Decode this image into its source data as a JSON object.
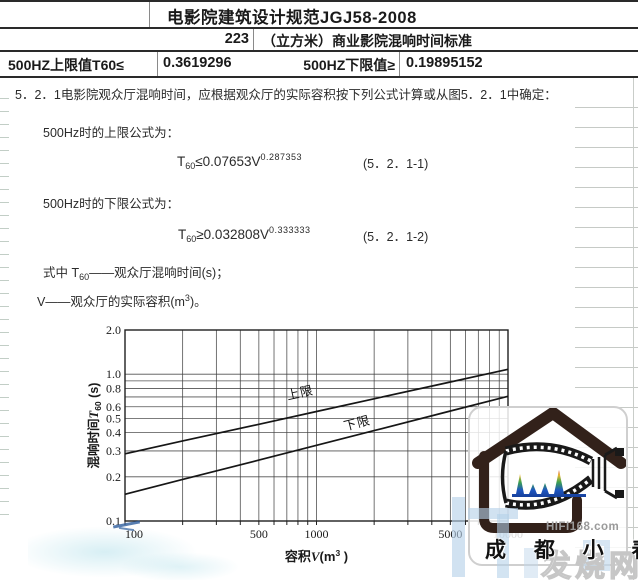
{
  "colors": {
    "table_border": "#2a2a2a",
    "grid_line": "#3f3f3f",
    "series_line": "#161616",
    "watermark_brown": "#32211a",
    "watermark_blue": "#b4d0e8",
    "hifi_gray": "#9a9a9a",
    "fsw_gray": "#c6c6c6"
  },
  "sheet": {
    "title": "电影院建筑设计规范JGJ58-2008",
    "volume_value": "223",
    "volume_caption": "（立方米）商业影院混响时间标准",
    "upper_label": "500HZ上限值T60≤",
    "upper_value": "0.3619296",
    "lower_label": "500HZ下限值≥",
    "lower_value": "0.19895152"
  },
  "body": {
    "clause": "5．2．1电影院观众厅混响时间，应根据观众厅的实际容积按下列公式计算或从图5．2．1中确定：",
    "upper_intro": "500Hz时的上限公式为：",
    "formula_upper": {
      "t": "T",
      "sub": "60",
      "mid": "≤0.07653V",
      "sup": "0.287353",
      "eq_no": "(5．2．1-1)"
    },
    "lower_intro": "500Hz时的下限公式为：",
    "formula_lower": {
      "t": "T",
      "sub": "60",
      "mid": "≥0.032808V",
      "sup": "0.333333",
      "eq_no": "(5．2．1-2)"
    },
    "where_t": {
      "pre": "式中 T",
      "sub": "60",
      "post": "——观众厅混响时间(s)；"
    },
    "where_v": {
      "pre": "V——观众厅的实际容积(m",
      "sup": "3",
      "post": ")。"
    }
  },
  "chart_data": {
    "type": "line",
    "x_scale": "log",
    "y_scale": "log",
    "xlabel": "容积V(m³)",
    "ylabel": "混响时间T60(s)",
    "xlabel_parts": [
      {
        "t": "容积"
      },
      {
        "t": "V",
        "i": true
      },
      {
        "t": "(m"
      },
      {
        "t": "3",
        "sup": true
      },
      {
        "t": ")"
      }
    ],
    "ylabel_parts": [
      {
        "t": "混响时间"
      },
      {
        "t": "T",
        "i": true
      },
      {
        "t": "60",
        "sub": true
      },
      {
        "t": "(s)"
      }
    ],
    "xlim": [
      100,
      10000
    ],
    "ylim": [
      0.1,
      2.0
    ],
    "x_ticks": [
      100,
      500,
      1000,
      5000,
      10000
    ],
    "x_tick_labels": [
      "100",
      "500",
      "1000",
      "5000",
      "10000"
    ],
    "y_ticks": [
      0.1,
      0.2,
      0.3,
      0.4,
      0.5,
      0.6,
      0.8,
      1.0,
      2.0
    ],
    "y_tick_labels": [
      "0.1",
      "0.2",
      "0.3",
      "0.4",
      "0.5",
      "0.6",
      "0.8",
      "1.0",
      "2.0"
    ],
    "grid": true,
    "legend_position": "labels-on-lines",
    "series": [
      {
        "name": "上限",
        "formula": "T60=0.07653·V^0.287353",
        "x": [
          100,
          200,
          500,
          1000,
          2000,
          5000,
          10000
        ],
        "y": [
          0.287,
          0.351,
          0.456,
          0.557,
          0.68,
          0.885,
          1.08
        ]
      },
      {
        "name": "下限",
        "formula": "T60=0.032808·V^0.333333",
        "x": [
          100,
          200,
          500,
          1000,
          2000,
          5000,
          10000
        ],
        "y": [
          0.152,
          0.192,
          0.26,
          0.328,
          0.413,
          0.561,
          0.707
        ]
      }
    ],
    "annotations": [
      {
        "text": "上限",
        "v": 830,
        "t": 0.7,
        "angle": -12.4
      },
      {
        "text": "下限",
        "v": 1650,
        "t": 0.435,
        "angle": -14.2
      }
    ]
  },
  "watermark": {
    "site": "HIFI168.com",
    "name": "成 都 小 春",
    "tag": "发烧网"
  }
}
